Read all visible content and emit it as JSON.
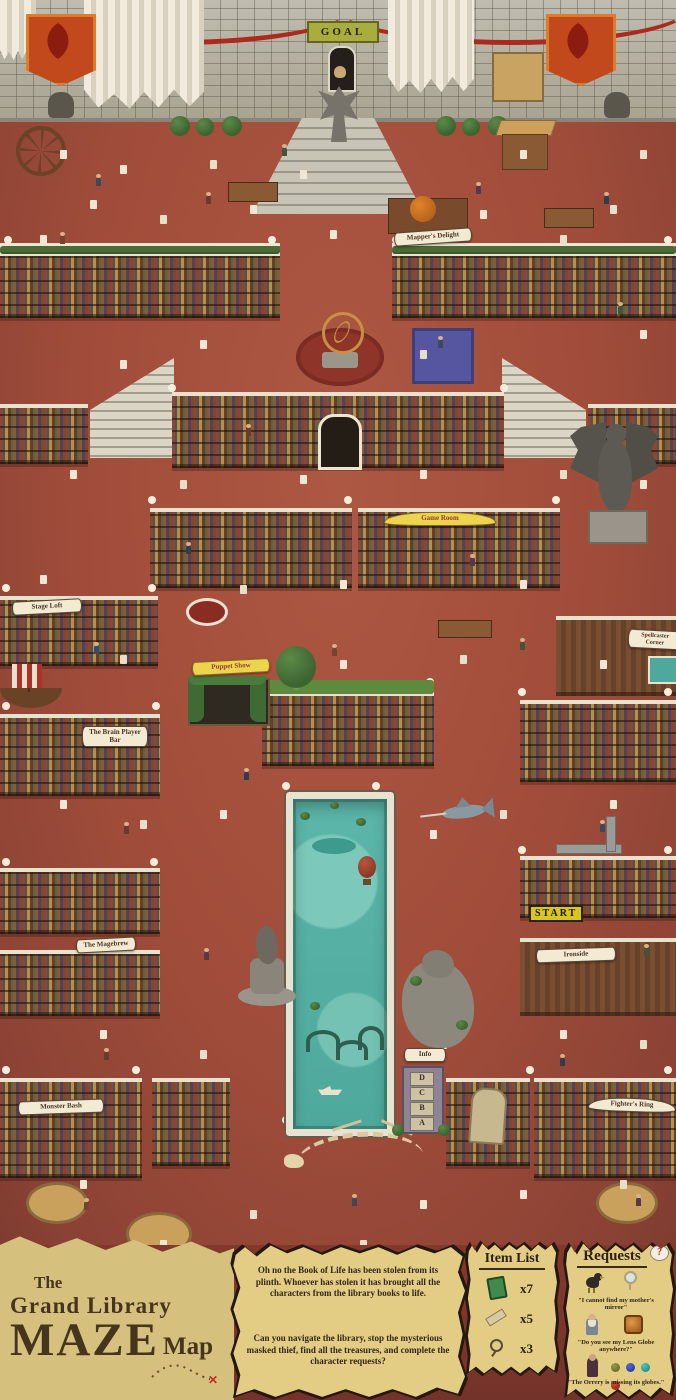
{
  "map": {
    "goal_sign": "GOAL",
    "start_sign": "START",
    "info_sign": "Info",
    "info_board_letters": [
      "D",
      "C",
      "B",
      "A"
    ],
    "locations": {
      "mappers_delight": "Mapper's Delight",
      "game_room": "Game Room",
      "stage_loft": "Stage Loft",
      "spellcaster_corner": "Spellcaster Corner",
      "puppet_show": "Puppet Show",
      "brain_player_bar": "The Brain Player Bar",
      "magebrew": "The Magebrew",
      "ironside": "Ironside",
      "monster_bash": "Monster Bash",
      "fighters_ring": "Fighter's Ring"
    }
  },
  "footer": {
    "title": {
      "pre": "The",
      "main": "Grand Library",
      "maze": "MAZE",
      "map": "Map"
    },
    "story": {
      "paragraph1": "Oh no the Book of Life has been stolen from its plinth. Whoever has stolen it has brought all the characters from the library books to life.",
      "paragraph2": "Can you navigate the library, stop the mysterious masked thief, find all the treasures, and complete the character requests?"
    },
    "item_list": {
      "title": "Item List",
      "items": [
        {
          "icon": "green-book-icon",
          "count": "x7"
        },
        {
          "icon": "scroll-icon",
          "count": "x5"
        },
        {
          "icon": "magnifying-glass-icon",
          "count": "x3"
        }
      ]
    },
    "requests": {
      "title": "Requests",
      "bubble": "?",
      "items": [
        {
          "character": "raven-character",
          "wanted": "hand-mirror-icon",
          "quote": "\"I cannot find my mother's mirror\""
        },
        {
          "character": "wizard-character",
          "wanted": "lens-globe-icon",
          "quote": "\"Do you see my Lens Globe anywhere?\""
        },
        {
          "character": "hooded-character",
          "wanted": "orrery-globes-icons",
          "quote": "\"The Orrery is missing its globes.\""
        }
      ]
    }
  },
  "colors": {
    "floor": "#a24e3c",
    "floor_dark": "#7c382c",
    "parchment": "#e3cd85",
    "pool_water": "#58b3a8",
    "stone": "#b4b0a4",
    "wood": "#7b4f33",
    "accent_red": "#ab2a1e",
    "banner_orange": "#c2491c",
    "goal_green": "#a9ad3e",
    "start_yellow": "#d9c523"
  }
}
